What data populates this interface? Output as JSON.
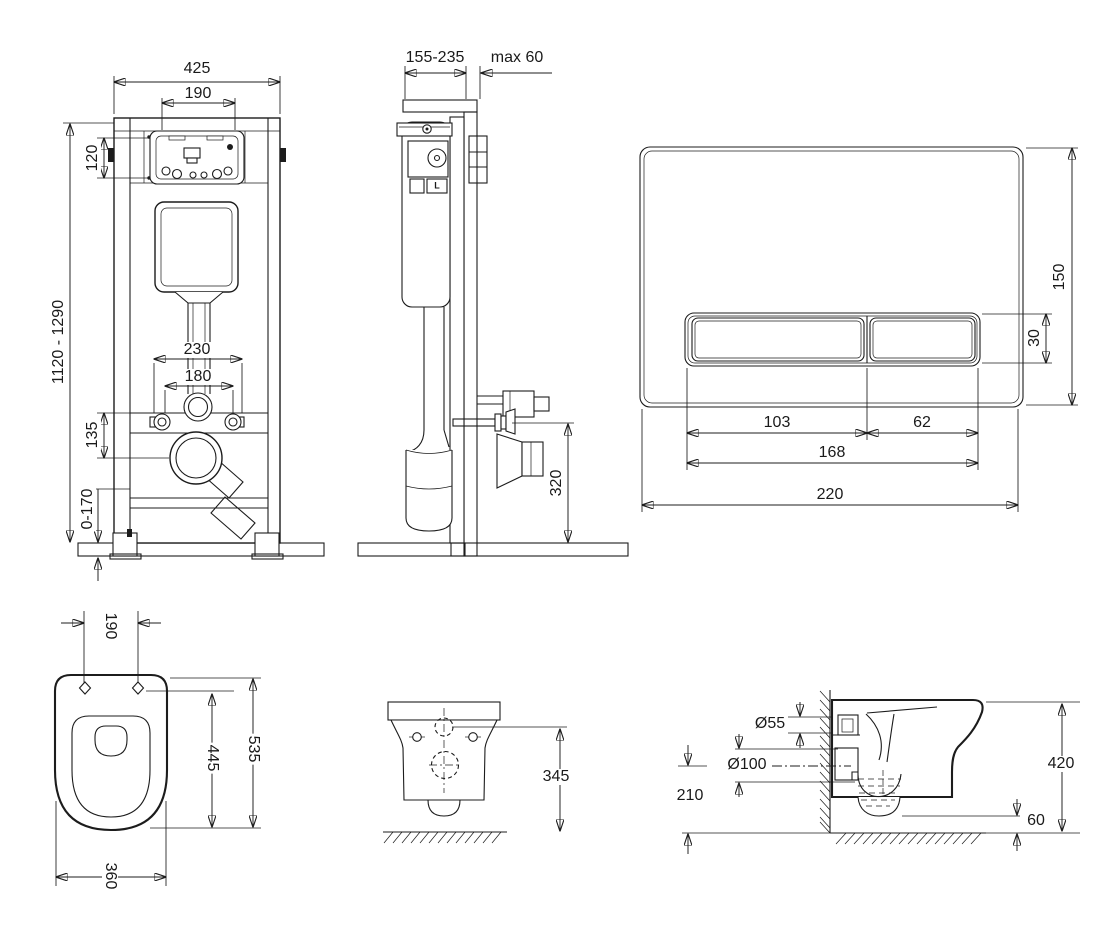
{
  "frame_front": {
    "width": "425",
    "opening_width": "190",
    "opening_height": "120",
    "height_range": "1120 - 1290",
    "bolt_spacing_outer": "230",
    "bolt_spacing_inner": "180",
    "outlet_offset": "135",
    "leg_adjust_range": "0-170"
  },
  "frame_side": {
    "depth_range": "155-235",
    "wall_thickness_max": "max 60",
    "outlet_height": "320",
    "lever_label": "L"
  },
  "flush_plate": {
    "height": "150",
    "button_height": "30",
    "large_button_width": "103",
    "small_button_width": "62",
    "buttons_total_width": "168",
    "width": "220"
  },
  "bowl_top": {
    "bolt_spacing": "190",
    "length": "535",
    "bolt_to_front": "445",
    "width": "360"
  },
  "bowl_front": {
    "inlet_height": "345"
  },
  "bowl_side": {
    "inlet_diameter": "Ø55",
    "outlet_diameter": "Ø100",
    "outlet_center_height": "210",
    "total_height": "420",
    "bottom_clearance": "60"
  },
  "colors": {
    "line": "#1c1c1c",
    "floor": "#9c9c9c",
    "wall": "#ababab",
    "top_rail": "#8f8f8f",
    "bracket": "#575757",
    "background": "#ffffff"
  }
}
